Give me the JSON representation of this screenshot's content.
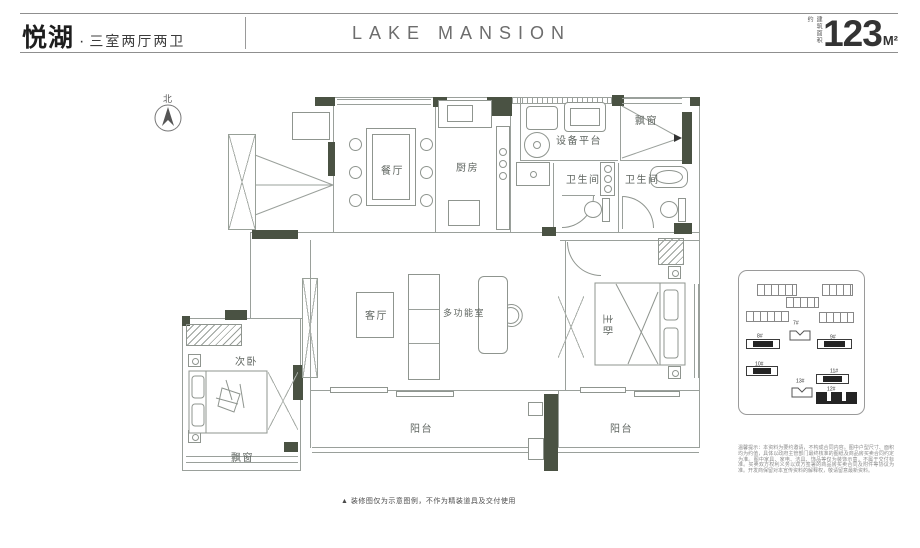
{
  "header": {
    "project_name": "悦湖",
    "separator": "·",
    "unit_type": "三室两厅两卫",
    "brand": "LAKE MANSION",
    "area_label": "建筑面积约",
    "area_value": "123",
    "area_unit": "M²"
  },
  "compass": {
    "north_label": "北"
  },
  "rooms": {
    "dining": "餐厅",
    "kitchen": "厨房",
    "equipment_platform": "设备平台",
    "bathroom_1": "卫生间",
    "bathroom_2": "卫生间",
    "bay_window_top": "飘窗",
    "living": "客厅",
    "multifunction": "多功能室",
    "master_bedroom": "主卧",
    "second_bedroom": "次卧",
    "bay_window_bottom": "飘窗",
    "balcony_left": "阳台",
    "balcony_right": "阳台"
  },
  "keyplan": {
    "building_labels": [
      "7#",
      "8#",
      "9#",
      "10#",
      "11#",
      "13#",
      "12#"
    ]
  },
  "notes": {
    "plan_note": "▲ 装修图仅为示意图例，不作为精装道具及交付使用",
    "disclaimer": "温馨提示：本资料为要约邀请，不构成合同内容。图中户型尺寸、面积均为约值，具体以政府主管部门最终核准的图纸及商品房买卖合同约定为准。图中家具、家电、洁具、饰品等仅为装饰示意，不属于交付标准。买卖双方权利义务以双方签署的商品房买卖合同及附件等协议为准。开发商保留对本宣传资料的解释权，敬请留意最新资料。"
  },
  "colors": {
    "wall": "#4a5243",
    "line": "#9aa09b",
    "accent_text": "#1e1e1e"
  }
}
